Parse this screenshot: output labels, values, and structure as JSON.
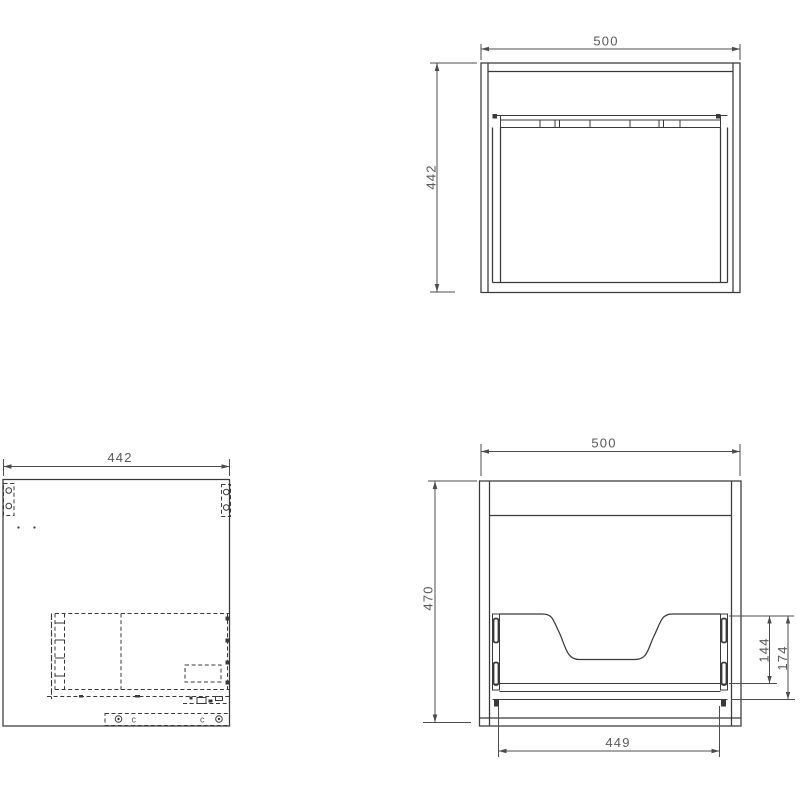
{
  "colors": {
    "line": "#39393b",
    "dimension": "#4c4c4e",
    "text": "#59595b",
    "background": "#ffffff"
  },
  "dimensions": {
    "top_view_width": "500",
    "top_view_depth": "442",
    "side_view_depth": "442",
    "rear_view_width": "500",
    "rear_view_height": "470",
    "drawer_opening_width": "449",
    "drawer_slide_height": "144",
    "drawer_assembly_height": "174"
  },
  "annotations": {
    "cam_marks": [
      "c",
      "c"
    ]
  }
}
